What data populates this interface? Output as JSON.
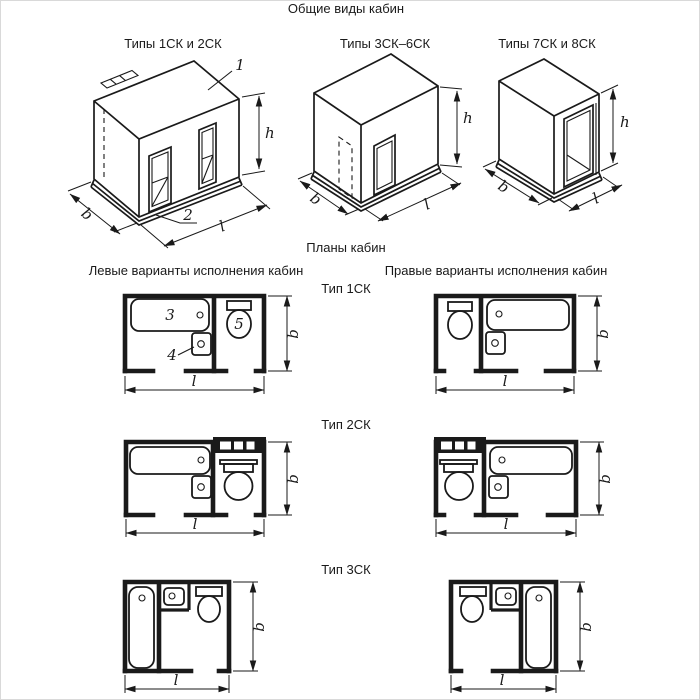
{
  "colors": {
    "ink": "#1a1a1a",
    "paper": "#ffffff"
  },
  "titles": {
    "general_views": "Общие виды кабин",
    "plans": "Планы кабин",
    "left_variants": "Левые варианты исполнения кабин",
    "right_variants": "Правые варианты исполнения кабин"
  },
  "iso_views": [
    {
      "label": "Типы 1СК и 2СК"
    },
    {
      "label": "Типы 3СК–6СК"
    },
    {
      "label": "Типы 7СК и 8СК"
    }
  ],
  "plan_rows": [
    {
      "label": "Тип 1СК"
    },
    {
      "label": "Тип 2СК"
    },
    {
      "label": "Тип 3СК"
    }
  ],
  "dimensions": {
    "width": "b",
    "length": "l",
    "height": "h"
  },
  "callouts": {
    "roof": "1",
    "base": "2",
    "bath": "3",
    "washbasin": "4",
    "toilet": "5"
  }
}
